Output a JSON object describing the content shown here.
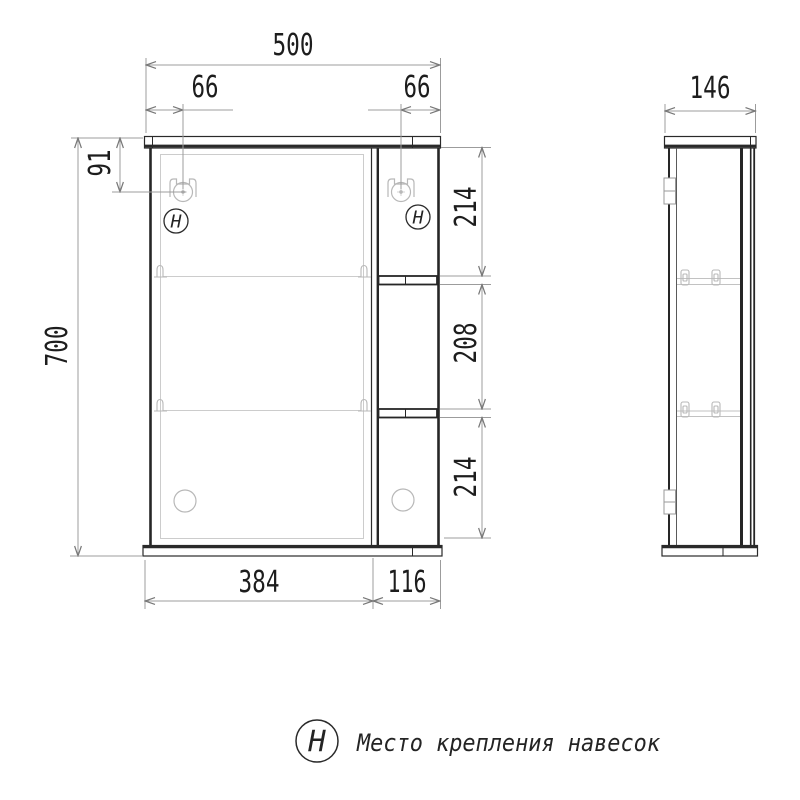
{
  "drawing": {
    "dims": {
      "front_width": "500",
      "hook_left_offset": "66",
      "hook_right_offset": "66",
      "hook_top_offset": "91",
      "front_height": "700",
      "right_seg_top": "214",
      "right_seg_mid": "208",
      "right_seg_bottom": "214",
      "door_width": "384",
      "open_shelf_width": "116",
      "side_depth": "146"
    },
    "symbols": {
      "hanger_mark": "Н"
    },
    "legend": {
      "symbol": "Н",
      "text": "Место крепления навесок"
    },
    "colors": {
      "outline": "#262626",
      "detail": "#b8b8b8",
      "dimension": "#9a9a9a",
      "background": "#ffffff"
    }
  }
}
